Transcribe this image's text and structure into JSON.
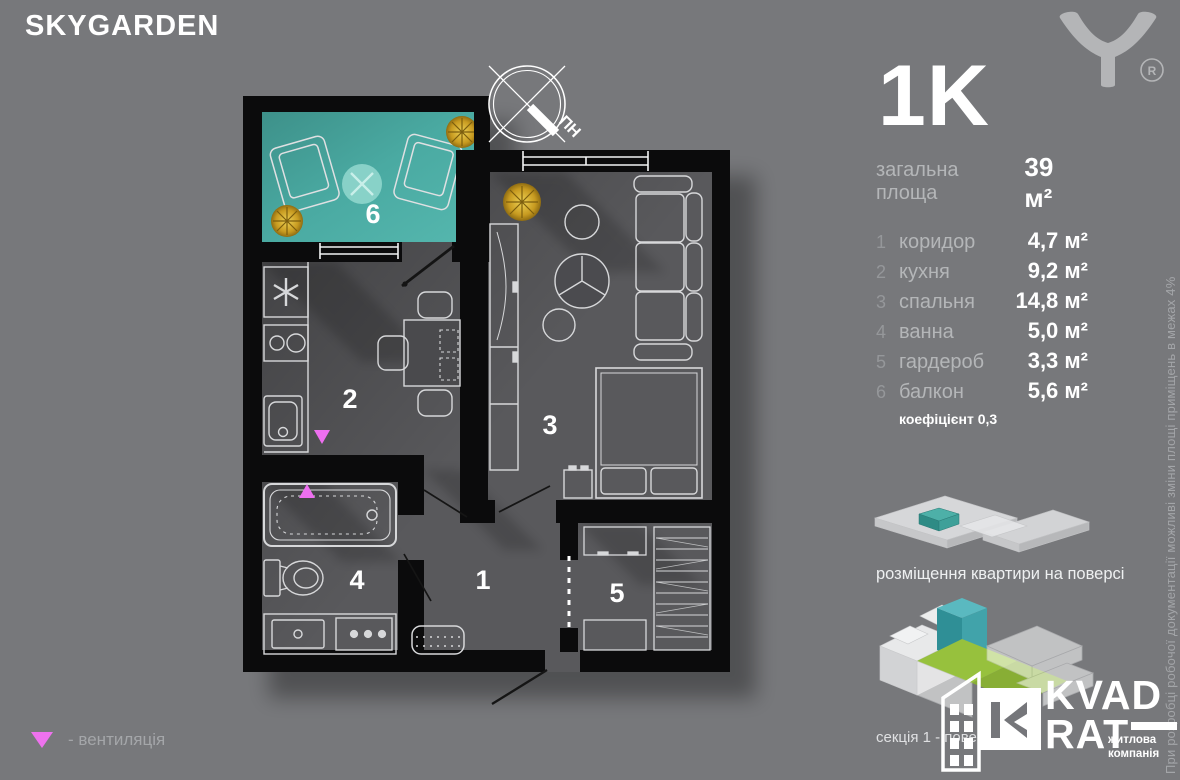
{
  "header": {
    "title": "SKYGARDEN",
    "registered_mark": "R"
  },
  "info": {
    "type": "1K",
    "total_label": "загальна площа",
    "total_value": "39 м²",
    "rooms": [
      {
        "num": "1",
        "label": "коридор",
        "area": "4,7 м²"
      },
      {
        "num": "2",
        "label": "кухня",
        "area": "9,2 м²"
      },
      {
        "num": "3",
        "label": "спальня",
        "area": "14,8 м²"
      },
      {
        "num": "4",
        "label": "ванна",
        "area": "5,0 м²"
      },
      {
        "num": "5",
        "label": "гардероб",
        "area": "3,3 м²"
      },
      {
        "num": "6",
        "label": "балкон",
        "area": "5,6 м²"
      }
    ],
    "coefficient": "коефіцієнт 0,3"
  },
  "plan": {
    "compass_label": "ПН",
    "rooms_on_plan": [
      "1",
      "2",
      "3",
      "4",
      "5",
      "6"
    ]
  },
  "placement": {
    "caption": "розміщення квартири на поверсі"
  },
  "section": {
    "label": "секція 1 - поверх 17"
  },
  "brand": {
    "line1": "KVAD",
    "line2": "RAT",
    "tagline_line1": "житлова",
    "tagline_line2": "компанія"
  },
  "legend": {
    "vent": "- вентиляція"
  },
  "disclaimer": "При розробці робочої документації можливі зміни площі приміщень в межах 4%",
  "colors": {
    "background": "#77787b",
    "walls": "#0b0b0c",
    "floor": "#59595c",
    "balcony_teal": "#47a9a1",
    "vent_pink": "#ee6ff0",
    "render_green": "#97c13d",
    "logo_gray": "#b4b5b7"
  }
}
